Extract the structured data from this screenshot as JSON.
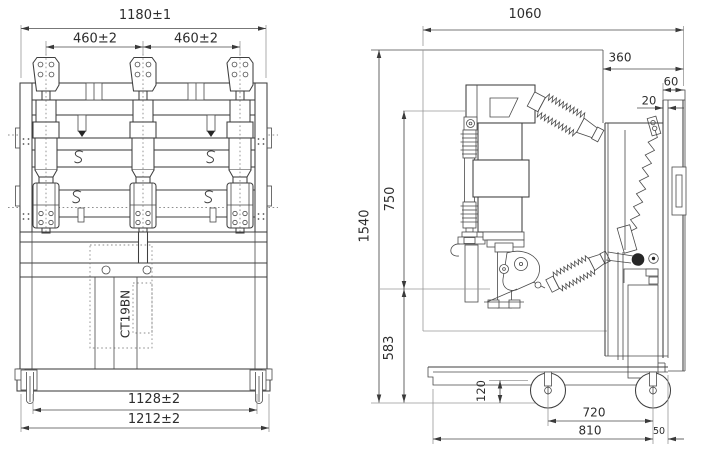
{
  "drawing": {
    "product_label": "CT19BN",
    "front_view": {
      "dims": {
        "total_width": "1180±1",
        "pole_pitch_left": "460±2",
        "pole_pitch_right": "460±2",
        "base_width_inner": "1128±2",
        "base_width_outer": "1212±2"
      }
    },
    "side_view": {
      "dims": {
        "overall_depth": "1060",
        "rear_section_depth": "360",
        "top_offset": "60",
        "panel_gap": "20",
        "overall_height": "1540",
        "upper_section_height": "750",
        "lower_section_height": "583",
        "wheel_section_height": "120",
        "wheel_base": "720",
        "chassis_depth": "810",
        "rear_overhang": "50"
      }
    }
  }
}
